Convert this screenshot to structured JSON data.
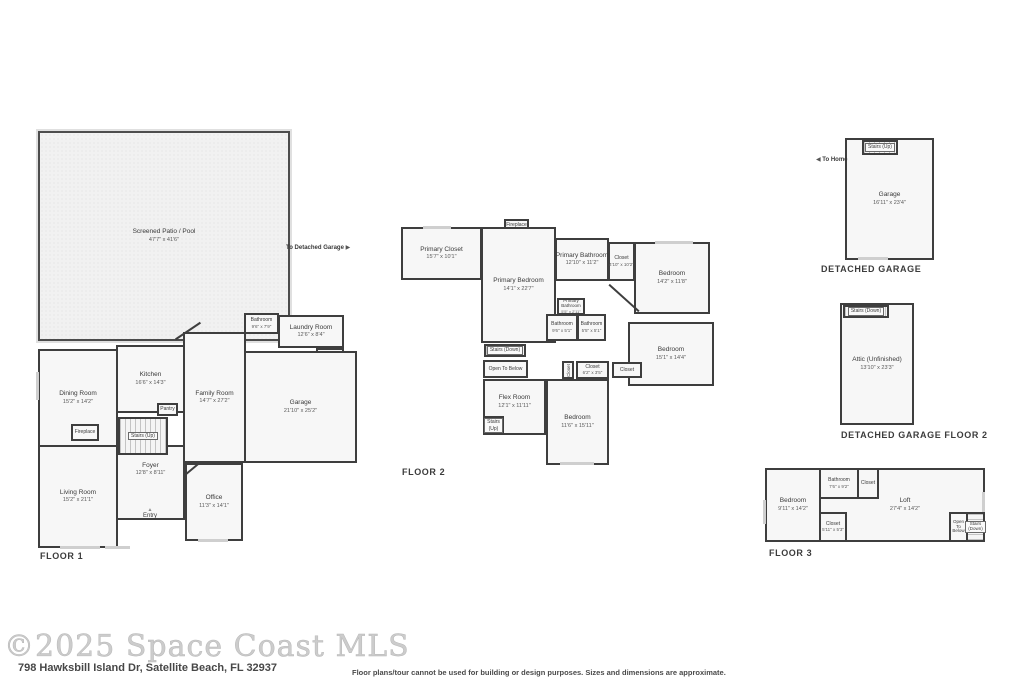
{
  "floor1": {
    "caption": "FLOOR 1",
    "to_detached_garage": "To Detached Garage",
    "arrow_right": "▶",
    "entry_marker": "▲",
    "patio": {
      "name": "Screened Patio / Pool",
      "dims": "47'7\" x 41'6\""
    },
    "dining": {
      "name": "Dining Room",
      "dims": "15'2\" x 14'2\""
    },
    "kitchen": {
      "name": "Kitchen",
      "dims": "16'6\" x 14'3\""
    },
    "family": {
      "name": "Family Room",
      "dims": "14'7\" x 27'2\""
    },
    "living": {
      "name": "Living Room",
      "dims": "15'2\" x 21'1\""
    },
    "foyer": {
      "name": "Foyer",
      "dims": "12'8\" x 8'11\""
    },
    "office": {
      "name": "Office",
      "dims": "11'3\" x 14'1\""
    },
    "bathroom": {
      "name": "Bathroom",
      "dims": "9'6\" x 7'9\""
    },
    "laundry": {
      "name": "Laundry Room",
      "dims": "12'6\" x 8'4\""
    },
    "closet": {
      "name": "Closet"
    },
    "garage": {
      "name": "Garage",
      "dims": "21'10\" x 25'2\""
    },
    "pantry": {
      "name": "Pantry"
    },
    "fireplace": {
      "name": "Fireplace"
    },
    "stairs": {
      "name": "Stairs (Up)"
    },
    "entry": {
      "name": "Entry"
    }
  },
  "floor2": {
    "caption": "FLOOR 2",
    "primary_closet": {
      "name": "Primary Closet",
      "dims": "15'7\" x 10'1\""
    },
    "fireplace": {
      "name": "Fireplace"
    },
    "primary_bedroom": {
      "name": "Primary Bedroom",
      "dims": "14'1\" x 22'7\""
    },
    "primary_bathroom": {
      "name": "Primary Bathroom",
      "dims": "12'10\" x 11'2\""
    },
    "closet_a": {
      "name": "Closet",
      "dims": "4'10\" x 10'2\""
    },
    "bedroom_a": {
      "name": "Bedroom",
      "dims": "14'2\" x 11'8\""
    },
    "primary_bathroom_small": {
      "name": "Primary Bathroom",
      "dims": "5'5\" x 2'11\""
    },
    "bathroom_a": {
      "name": "Bathroom",
      "dims": "9'6\" x 5'1\""
    },
    "bathroom_b": {
      "name": "Bathroom",
      "dims": "5'5\" x 5'1\""
    },
    "bedroom_b": {
      "name": "Bedroom",
      "dims": "15'1\" x 14'4\""
    },
    "stairs_down": {
      "name": "Stairs (Down)"
    },
    "open_to_below": {
      "name": "Open To Below"
    },
    "closet_v": {
      "name": "Closet"
    },
    "closet_b": {
      "name": "Closet",
      "dims": "6'2\" x 3'5\""
    },
    "closet_c": {
      "name": "Closet"
    },
    "flex": {
      "name": "Flex Room",
      "dims": "12'1\" x 11'11\""
    },
    "stairs_up": {
      "name": "Stairs (Up)"
    },
    "bedroom_c": {
      "name": "Bedroom",
      "dims": "11'6\" x 15'11\""
    }
  },
  "garage1": {
    "caption": "DETACHED GARAGE",
    "stairs": {
      "name": "Stairs (Up)"
    },
    "to_home": "To Home",
    "arrow_left": "◀",
    "garage": {
      "name": "Garage",
      "dims": "16'11\" x 23'4\""
    }
  },
  "garage2": {
    "caption": "DETACHED GARAGE FLOOR 2",
    "stairs": {
      "name": "Stairs (Down)"
    },
    "attic": {
      "name": "Attic (Unfinished)",
      "dims": "13'10\" x 23'3\""
    }
  },
  "floor3": {
    "caption": "FLOOR 3",
    "bedroom": {
      "name": "Bedroom",
      "dims": "9'11\" x 14'2\""
    },
    "bathroom": {
      "name": "Bathroom",
      "dims": "7'6\" x 9'2\""
    },
    "closet_top": {
      "name": "Closet"
    },
    "loft": {
      "name": "Loft",
      "dims": "27'4\" x 14'2\""
    },
    "closet_bottom": {
      "name": "Closet",
      "dims": "5'11\" x 5'3\""
    },
    "open_to_below": {
      "name": "Open To Below"
    },
    "stairs": {
      "name": "Stairs (Down)"
    }
  },
  "footer": {
    "watermark": "©2025 Space Coast MLS",
    "address": "798 Hawksbill Island Dr, Satellite Beach, FL 32937",
    "disclaimer": "Floor plans/tour cannot be used for building or design purposes. Sizes and dimensions are approximate."
  }
}
